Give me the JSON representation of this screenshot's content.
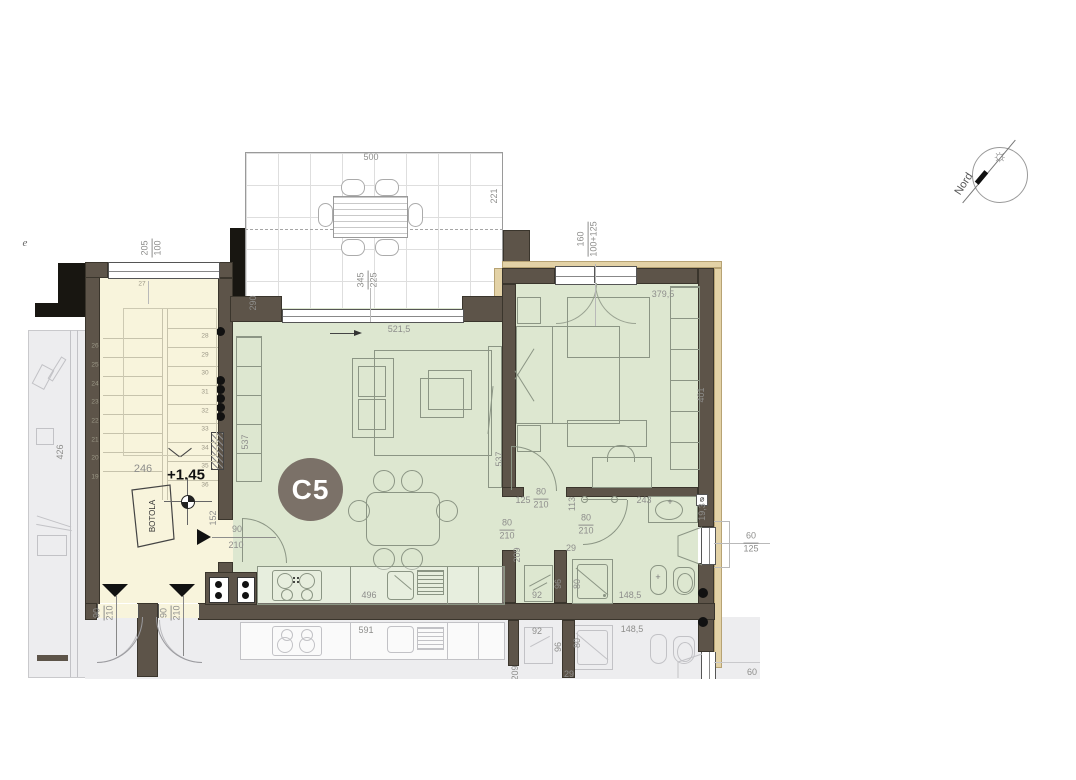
{
  "colors": {
    "wall": "#5d5449",
    "wall_black": "#181611",
    "room_green": "#dde7d0",
    "stair_cream": "#f8f4dc",
    "neighbor_gray": "#ededef",
    "beige_trim": "#e3d2a6",
    "badge_bg": "#7b7168",
    "dim_text": "#8e8e8c"
  },
  "north": {
    "label": "Nord"
  },
  "unit": {
    "badge": "C5",
    "elevation": "+1.45",
    "hatch_label": "BOTOLA",
    "edge_letter": "e"
  },
  "terrace": {
    "dim_width": "500",
    "dim_right": "221",
    "dim_left": "290",
    "dim_depth_num": "345",
    "dim_depth_den": "225"
  },
  "stairwell": {
    "window_num": "205",
    "window_den": "100",
    "landing_step": "27",
    "left_steps": [
      "26",
      "25",
      "24",
      "23",
      "22",
      "21",
      "20",
      "19"
    ],
    "right_steps": [
      "28",
      "29",
      "30",
      "31",
      "32",
      "33",
      "34",
      "35",
      "36"
    ],
    "dim_width": "246",
    "door_num": "90",
    "door_den": "210"
  },
  "living": {
    "dim_window": "521,5",
    "dim_left": "537",
    "dim_right": "537",
    "entry_num": "90",
    "entry_den": "210",
    "dim_entry_wall": "152",
    "dim_kitchen": "496"
  },
  "bedroom": {
    "window_num": "160",
    "window_den": "100+125",
    "dim_width": "379,5",
    "dim_depth": "401",
    "dim_desk": "243",
    "door_num": "80",
    "door_den": "210"
  },
  "hall": {
    "dim_wall": "125",
    "dim_wall2": "113",
    "dim_stub": "29",
    "dim_depth": "209",
    "door_num": "80",
    "door_den": "210"
  },
  "bath": {
    "dim_wash": "92",
    "dim_shower": "80",
    "dim_niche": "96",
    "dim_length": "148,5",
    "dim_right_wall": "19,3",
    "window_num": "60",
    "window_den": "125",
    "vent": "⌀",
    "door_num": "80",
    "door_den": "210"
  },
  "neighbor": {
    "dim_depth": "426",
    "dim_kitchen": "591",
    "dim_wash": "92",
    "dim_shower": "80",
    "dim_niche": "96",
    "dim_length": "148,5",
    "dim_window": "60",
    "dim_cut_a": "209",
    "dim_cut_b": "29"
  }
}
